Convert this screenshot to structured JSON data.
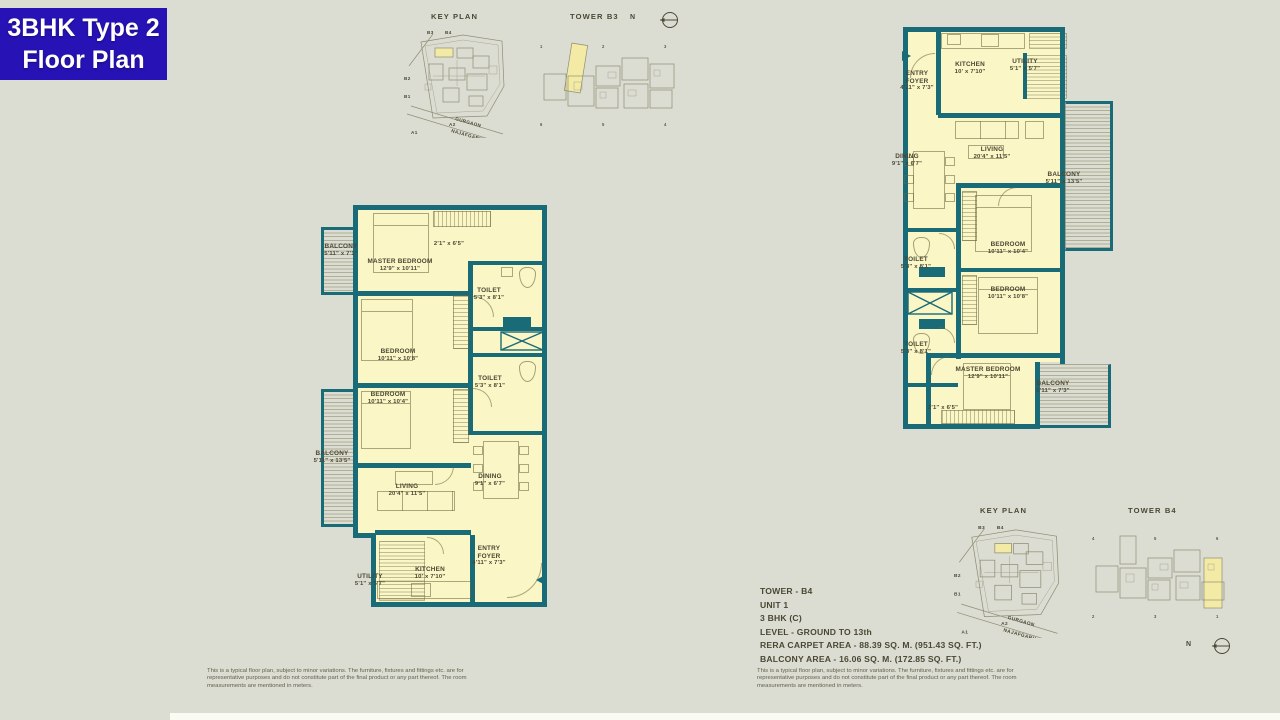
{
  "badge": {
    "line1": "3BHK Type 2",
    "line2": "Floor Plan",
    "bg": "#2712b5"
  },
  "colors": {
    "background": "#dcddd2",
    "wall_teal": "#1a6b78",
    "room_fill": "#faf6c6",
    "highlight": "#f3eaa6",
    "text": "#4a4734",
    "badge_blue": "#2712b5"
  },
  "key_plan_top": {
    "title": "KEY PLAN",
    "tower_label": "TOWER B3",
    "north": "N",
    "site_labels": {
      "b3": "B3",
      "b4": "B4",
      "b2": "B2",
      "b1": "B1",
      "a2": "A2",
      "a1": "A1"
    },
    "roads": {
      "r1": "GURGAON",
      "r2": "NAJAFGARH"
    },
    "units_top": [
      "1",
      "2",
      "3"
    ],
    "units_bottom": [
      "6",
      "5",
      "4"
    ]
  },
  "key_plan_bottom": {
    "title": "KEY PLAN",
    "tower_label": "TOWER B4",
    "north": "N",
    "site_labels": {
      "b3": "B3",
      "b4": "B4",
      "b2": "B2",
      "b1": "B1",
      "a2": "A2",
      "a1": "A1"
    },
    "roads": {
      "r1": "GURGAON",
      "r2": "NAJAFGARH"
    },
    "units_top": [
      "4",
      "5",
      "6"
    ],
    "units_bottom": [
      "2",
      "3",
      "1"
    ]
  },
  "plan_left": {
    "rooms": [
      {
        "name": "BALCONY",
        "dims": "5'11\" x 7'1\""
      },
      {
        "name": "MASTER BEDROOM",
        "dims": "12'9\" x 10'11\""
      },
      {
        "name": "",
        "dims": "2'1\" x 6'5\""
      },
      {
        "name": "TOILET",
        "dims": "5'3\" x 8'1\""
      },
      {
        "name": "BEDROOM",
        "dims": "10'11\" x 10'8\""
      },
      {
        "name": "TOILET",
        "dims": "5'3\" x 8'1\""
      },
      {
        "name": "BEDROOM",
        "dims": "10'11\" x 10'4\""
      },
      {
        "name": "BALCONY",
        "dims": "5'11\" x 13'5\""
      },
      {
        "name": "LIVING",
        "dims": "20'4\" x 11'5\""
      },
      {
        "name": "DINING",
        "dims": "9'1\" x 6'7\""
      },
      {
        "name": "ENTRY FOYER",
        "dims": "4'11\" x 7'3\""
      },
      {
        "name": "KITCHEN",
        "dims": "10' x 7'10\""
      },
      {
        "name": "UTILITY",
        "dims": "5'1\" x 5'7\""
      }
    ]
  },
  "plan_right": {
    "rooms": [
      {
        "name": "ENTRY FOYER",
        "dims": "4'11\" x 7'3\""
      },
      {
        "name": "KITCHEN",
        "dims": "10' x 7'10\""
      },
      {
        "name": "UTILITY",
        "dims": "5'1\" x 5'7\""
      },
      {
        "name": "DINING",
        "dims": "9'1\" x 6'7\""
      },
      {
        "name": "LIVING",
        "dims": "20'4\" x 11'5\""
      },
      {
        "name": "BALCONY",
        "dims": "5'11\" x 13'5\""
      },
      {
        "name": "BEDROOM",
        "dims": "10'11\" x 10'4\""
      },
      {
        "name": "TOILET",
        "dims": "5'3\" x 8'1\""
      },
      {
        "name": "BEDROOM",
        "dims": "10'11\" x 10'8\""
      },
      {
        "name": "TOILET",
        "dims": "5'3\" x 8'1\""
      },
      {
        "name": "MASTER BEDROOM",
        "dims": "12'9\" x 10'11\""
      },
      {
        "name": "BALCONY",
        "dims": "5'11\" x 7'3\""
      },
      {
        "name": "",
        "dims": "2'1\" x 6'5\""
      }
    ]
  },
  "info": {
    "l1": "TOWER - B4",
    "l2": "UNIT 1",
    "l3": "3 BHK (C)",
    "l4": "LEVEL - GROUND TO 13th",
    "l5": "RERA CARPET AREA - 88.39 SQ. M. (951.43 SQ. FT.)",
    "l6": "BALCONY AREA - 16.06 SQ. M. (172.85 SQ. FT.)"
  },
  "disclaimer": "This is a typical floor plan, subject to minor variations. The furniture, fixtures and fittings etc. are for representative purposes and do not constitute part of the final product or any part thereof. The room measurements are mentioned in meters."
}
